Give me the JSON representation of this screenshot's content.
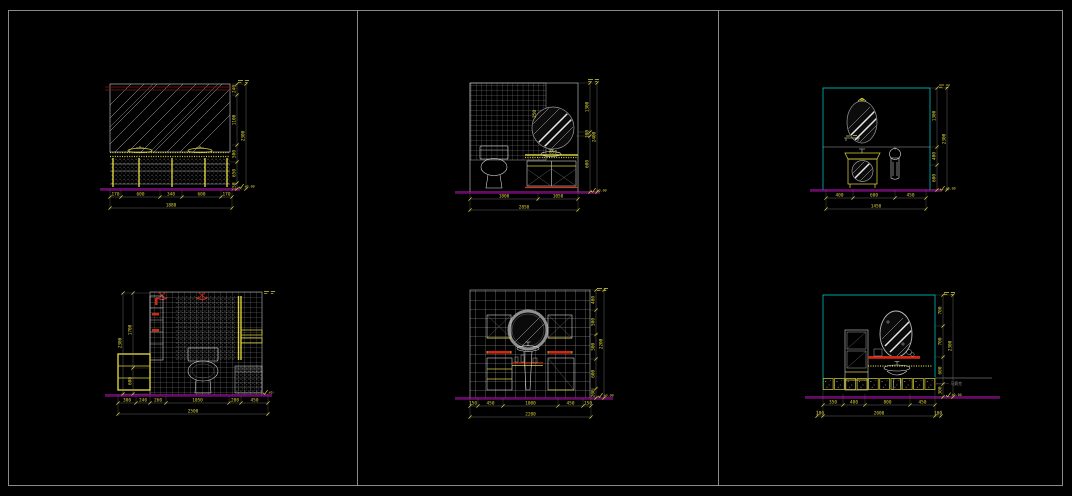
{
  "colors": {
    "background": "#000000",
    "sheet_border": "#8a8a8a",
    "drawing_white": "#e4e4e4",
    "dimension_yellow": "#d9d13b",
    "floor_magenta": "#c617c6",
    "accent_red": "#d23418",
    "dark_red_trim": "#7e1414",
    "room_outline_cyan": "#00d8d8",
    "hatch_gray": "#8f8f8f"
  },
  "panels": {
    "top_left": {
      "bottom_segments": [
        "170",
        "600",
        "340",
        "600",
        "170"
      ],
      "bottom_total": "1880",
      "right_segments": [
        "240",
        "1100",
        "500",
        "650",
        "150"
      ],
      "right_total": "2300",
      "floor_level": "±0.00"
    },
    "top_middle": {
      "bottom_segments": [
        "1800",
        "1050"
      ],
      "bottom_total": "2850",
      "right_segments": [
        "1300",
        "100",
        "600"
      ],
      "right_total": "2400",
      "mirror_side": "250",
      "mirror_width": "650",
      "floor_level": "±0.00"
    },
    "top_right": {
      "bottom_segments": [
        "400",
        "600",
        "450"
      ],
      "bottom_total": "1450",
      "right_segments": [
        "1300",
        "400",
        "600"
      ],
      "right_total": "2300",
      "floor_level": "±0.00"
    },
    "bottom_left": {
      "bottom_segments": [
        "300",
        "240",
        "260",
        "1050",
        "200",
        "450"
      ],
      "bottom_total": "2500",
      "left_segments": [
        "1700",
        "600"
      ],
      "left_total": "2300",
      "floor_level": "±0.00"
    },
    "bottom_middle": {
      "bottom_segments": [
        "150",
        "450",
        "1000",
        "450",
        "150"
      ],
      "bottom_total": "2200",
      "right_segments": [
        "400",
        "500",
        "500",
        "600",
        "200"
      ],
      "right_total": "2200",
      "floor_level": "±0.00"
    },
    "bottom_right": {
      "bottom_segments": [
        "350",
        "400",
        "800",
        "450"
      ],
      "bottom_outer": [
        "100",
        "2000",
        "100"
      ],
      "right_segments": [
        "700",
        "700",
        "600",
        "300"
      ],
      "right_total": "2300",
      "material_note": "马赛克",
      "floor_level": "±0.00"
    }
  }
}
